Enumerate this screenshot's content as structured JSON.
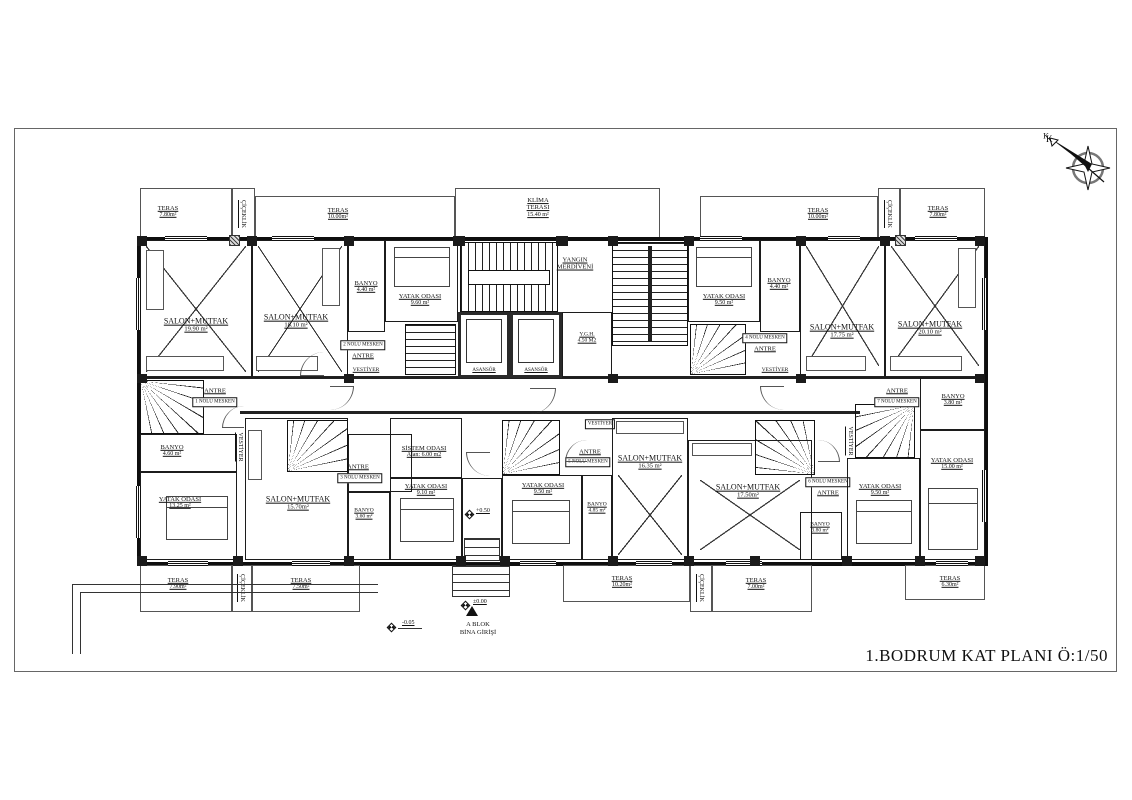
{
  "title": {
    "text": "1.BODRUM KAT PLANI Ö:1/50"
  },
  "compass": {
    "label": "K"
  },
  "common": {
    "antre": "ANTRE",
    "vestiyer": "VESTİYER",
    "ciceklik": "ÇİÇEKLİK",
    "asansor": "ASANSÖR",
    "teras": "TERAS"
  },
  "core": {
    "yangin1": "YANGIN",
    "yangin2": "MERDİVENİ",
    "ygh_name": "Y.G.H.",
    "ygh_area": "4.50 M2",
    "klima1": "KLİMA",
    "klima2": "TERASI",
    "klima_area": "15.40 m²"
  },
  "meskens": {
    "m1": "1 NOLU MESKEN",
    "m2": "2 NOLU MESKEN",
    "m3": "3 NOLU MESKEN",
    "m4": "4 NOLU MESKEN",
    "m5": "5 NOLU MESKEN",
    "m6": "6 NOLU MESKEN",
    "m7": "7 NOLU MESKEN"
  },
  "rooms": {
    "salon1": {
      "n": "SALON+MUTFAK",
      "a": "19.90 m²"
    },
    "salon2": {
      "n": "SALON+MUTFAK",
      "a": "18.10 m²"
    },
    "banyo_tl": {
      "n": "BANYO",
      "a": "4.40 m²"
    },
    "yatak_tl": {
      "n": "YATAK ODASI",
      "a": "9.60 m²"
    },
    "yatak_tr": {
      "n": "YATAK ODASI",
      "a": "9.50 m²"
    },
    "banyo_tr": {
      "n": "BANYO",
      "a": "4.40 m²"
    },
    "salon3": {
      "n": "SALON+MUTFAK",
      "a": "17.75 m²"
    },
    "salon4": {
      "n": "SALON+MUTFAK",
      "a": "20.10 m²"
    },
    "banyo_ml": {
      "n": "BANYO",
      "a": "4.60 m²"
    },
    "yatak_bl": {
      "n": "YATAK ODASI",
      "a": "13.25 m²"
    },
    "salon5": {
      "n": "SALON+MUTFAK",
      "a": "15.70m²"
    },
    "banyo_b2": {
      "n": "BANYO",
      "a": "3.60 m²"
    },
    "sistem": {
      "n": "SİSTEM ODASI",
      "a": "Alan: 6.00 m2"
    },
    "yatak_b2": {
      "n": "YATAK ODASI",
      "a": "9.10 m²"
    },
    "yatak_b3": {
      "n": "YATAK ODASI",
      "a": "9.50 m²"
    },
    "banyo_b3": {
      "n": "BANYO",
      "a": "4.85 m²"
    },
    "salon6": {
      "n": "SALON+MUTFAK",
      "a": "16.35 m²"
    },
    "salon7": {
      "n": "SALON+MUTFAK",
      "a": "17.50m²"
    },
    "banyo_b4": {
      "n": "BANYO",
      "a": "3.80 m²"
    },
    "yatak_b4": {
      "n": "YATAK ODASI",
      "a": "9.50 m²"
    },
    "yatak_b5": {
      "n": "YATAK ODASI",
      "a": "15.00 m²"
    },
    "banyo_mr": {
      "n": "BANYO",
      "a": "3.80 m²"
    }
  },
  "terraces": {
    "tl1": "7.80m²",
    "tl2": "10.00m²",
    "tr1": "10.00m²",
    "tr2": "7.80m²",
    "bl1": "7.90m²",
    "bl2": "7.50m²",
    "bc": "10.20m²",
    "br1": "7.00m²",
    "br2": "6.30m²"
  },
  "entrance": {
    "line1": "A BLOK",
    "line2": "BİNA GİRİŞİ",
    "level_floor": "+0.50",
    "level_entry": "±0.00",
    "level_path": "-0.05"
  }
}
